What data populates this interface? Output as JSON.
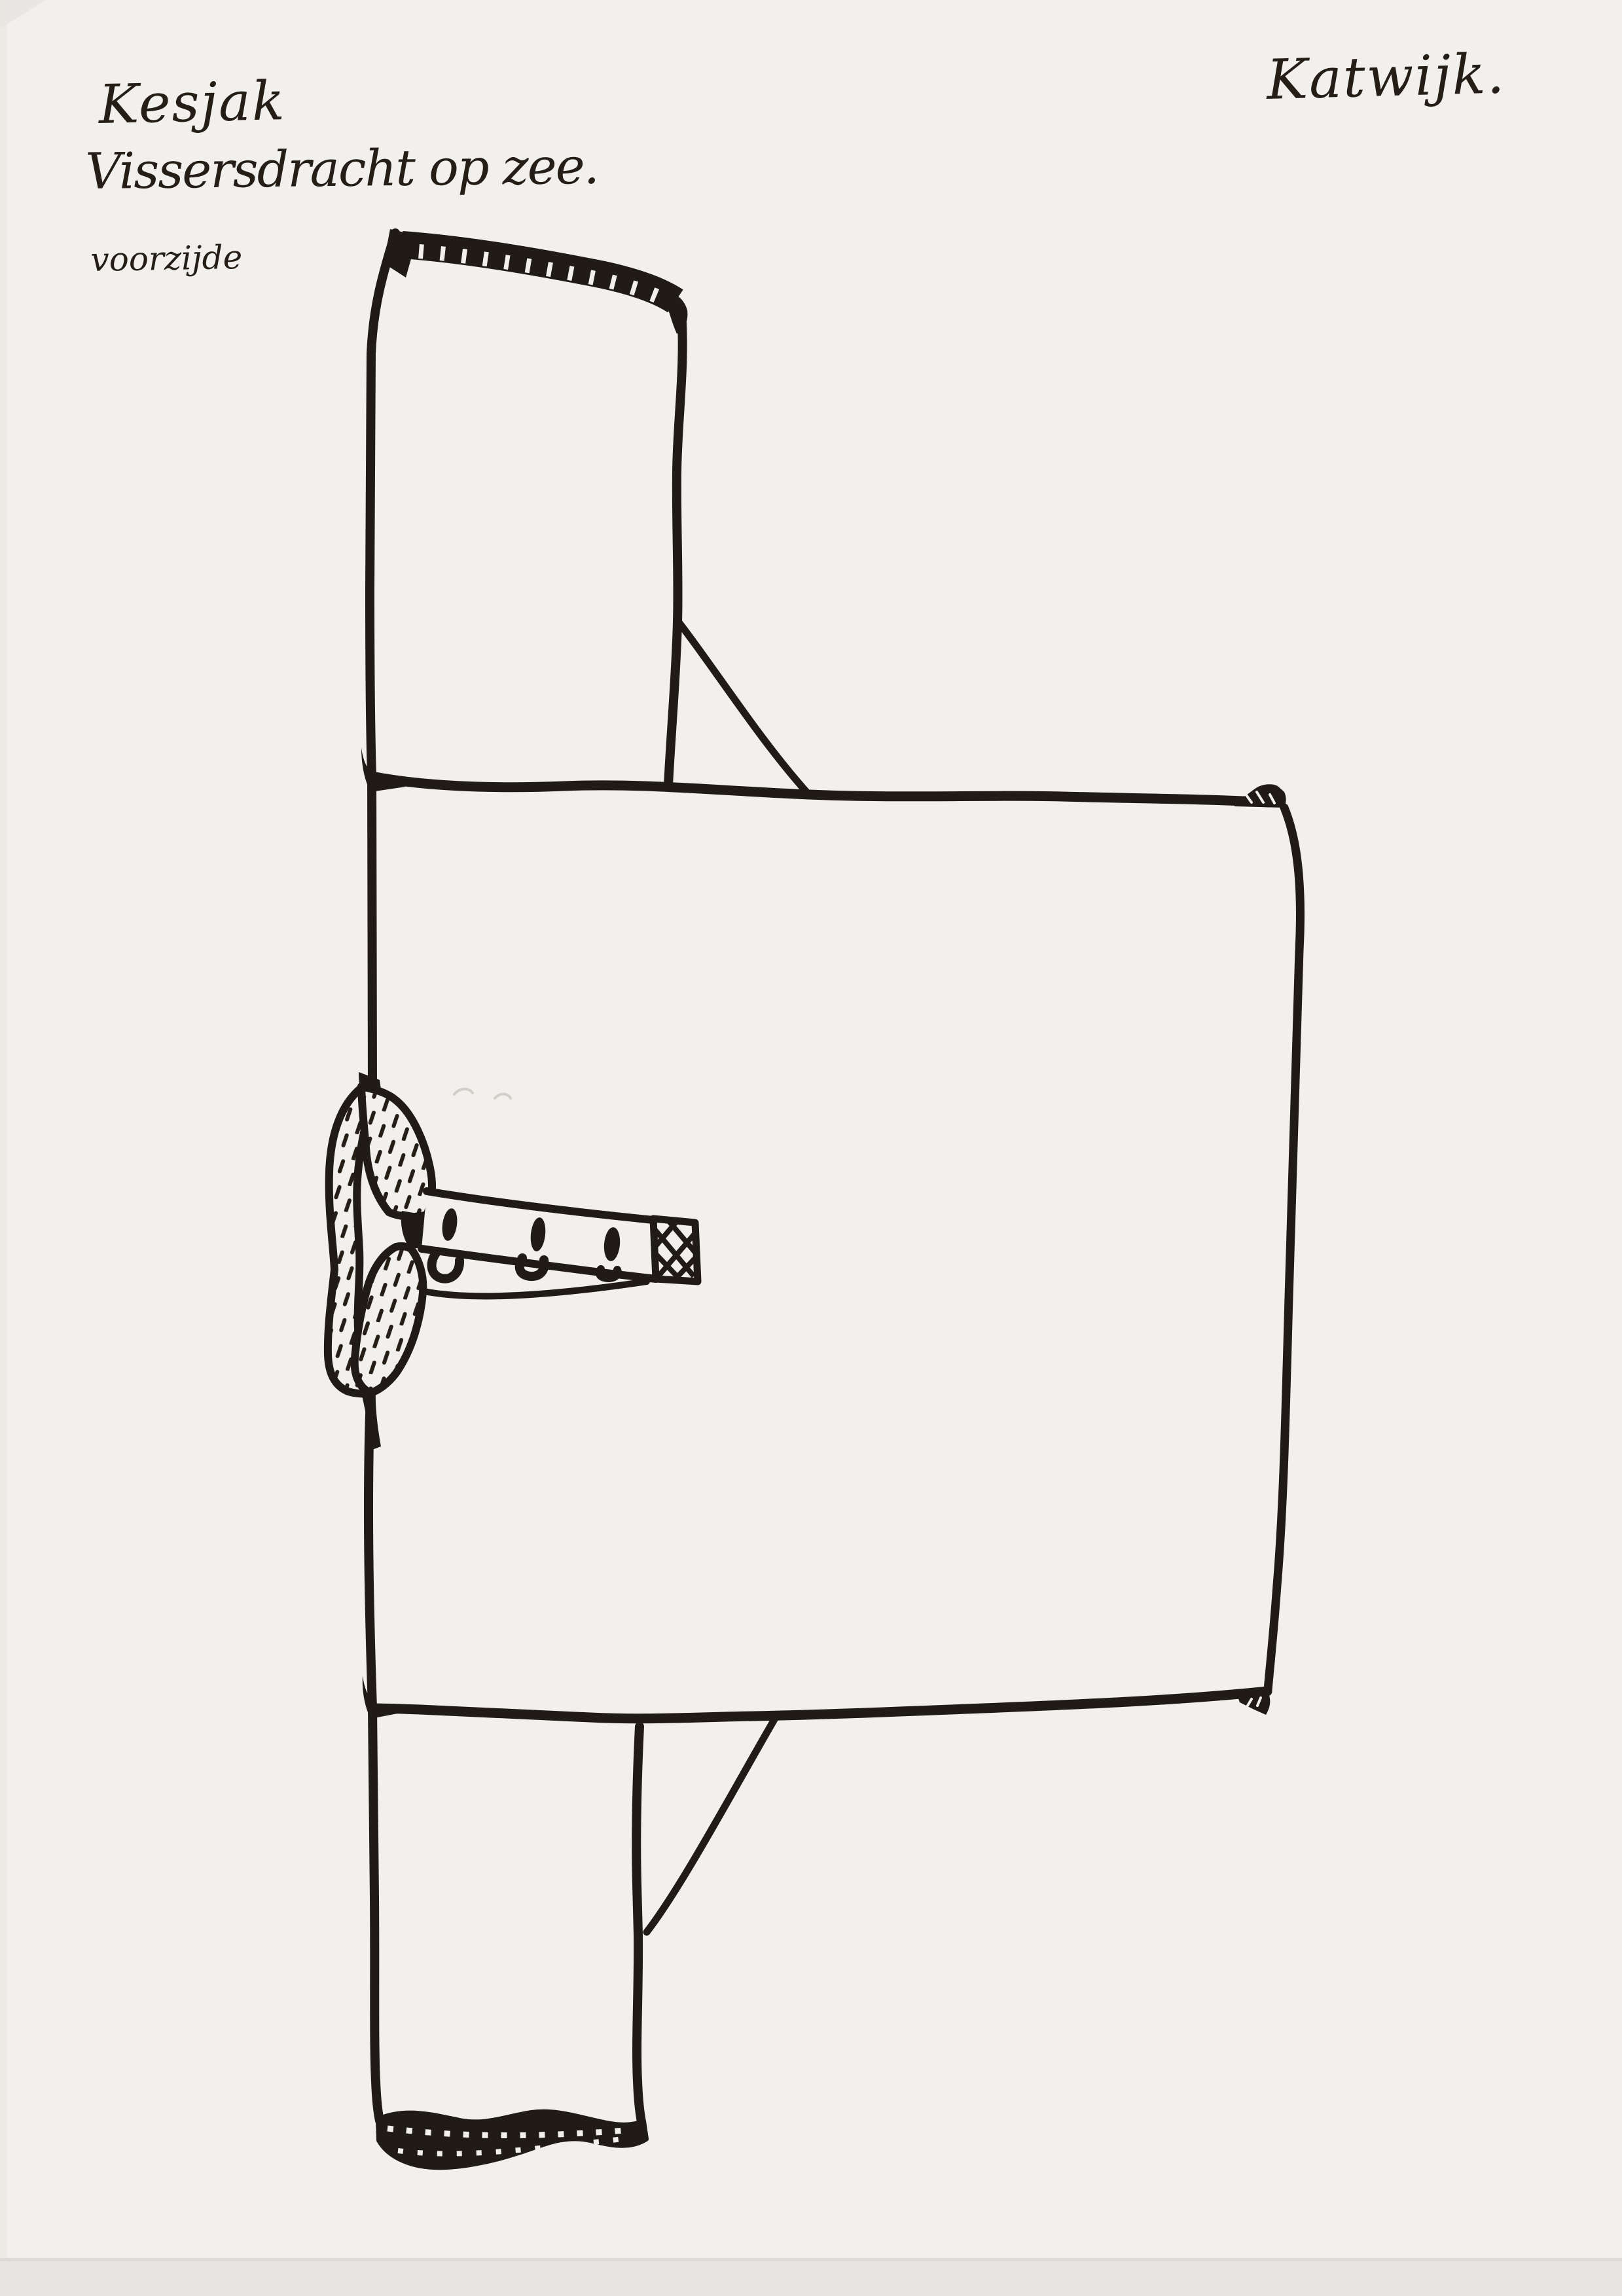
{
  "annotations": {
    "garment_name": "Kesjak",
    "subtitle": "Vissersdracht op zee.",
    "view_label": "voorzijde",
    "location": "Katwijk."
  },
  "colors": {
    "ink": "#201b16",
    "paper": "#f2f0ec",
    "scan_band": "#e7e5e1",
    "pencil": "#c9c6bf"
  },
  "figure": {
    "button_count": 3,
    "buttonhole_loop_count": 3
  }
}
